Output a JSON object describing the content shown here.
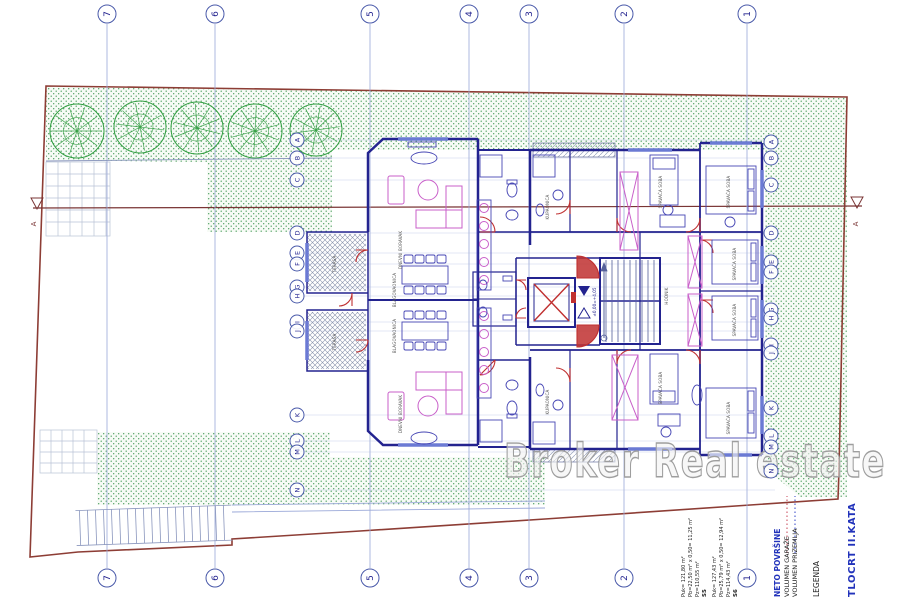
{
  "drawing": {
    "title": "TLOCRT II.KATA",
    "watermark": "Broker Real estate",
    "section_marker": "A",
    "level_text": "±0,00=+4,05"
  },
  "grid": {
    "column_labels": [
      "7",
      "6",
      "5",
      "4",
      "3",
      "2",
      "1"
    ],
    "row_labels_left": [
      "A",
      "B",
      "C",
      "D",
      "E",
      "F",
      "G",
      "H",
      "I",
      "J",
      "K",
      "L",
      "M",
      "N"
    ],
    "row_labels_right": [
      "A",
      "B",
      "C",
      "D",
      "E",
      "F",
      "G",
      "H",
      "I",
      "J",
      "K",
      "L",
      "M",
      "N"
    ]
  },
  "legend": {
    "heading": "LEGENDA",
    "net_areas_label": "NETO POVRŠINE",
    "volume_ground_label": "VOLUMEN PRIZEMLJA",
    "volume_garage_label": "VOLUMEN GARAŽE",
    "apartments": [
      {
        "id": "S6",
        "line1": "Pz=114,43 m²",
        "line2": "Pb=25,79 m² x 0,50= 12,94 m²",
        "line3": "Puk= 127,43 m²"
      },
      {
        "id": "S5",
        "line1": "Pz=110,55 m²",
        "line2": "Pb=22,50 m² x 0,50= 11,25 m²",
        "line3": "Puk= 121,80 m²"
      }
    ]
  },
  "rooms": [
    "DNEVNI BORAVAK",
    "DNEVNI BORAVAK",
    "BLAGOVAONICA",
    "BLAGOVAONICA",
    "TERASA",
    "TERASA",
    "KUPAONICA",
    "KUPAONICA",
    "SPAVAĆA SOBA",
    "SPAVAĆA SOBA",
    "SPAVAĆA SOBA",
    "SPAVAĆA SOBA",
    "SPAVAĆA SOBA",
    "SPAVAĆA SOBA",
    "HODNIK"
  ],
  "colors": {
    "walls": "#23238f",
    "furniture": "#c95fc9",
    "doors": "#c03030",
    "boundary": "#8d3d35",
    "grid": "#8c9ad4",
    "greenery": "#3f9e4f",
    "title_blue": "#2233bb",
    "watermark_gray": "#9e9e9e"
  }
}
